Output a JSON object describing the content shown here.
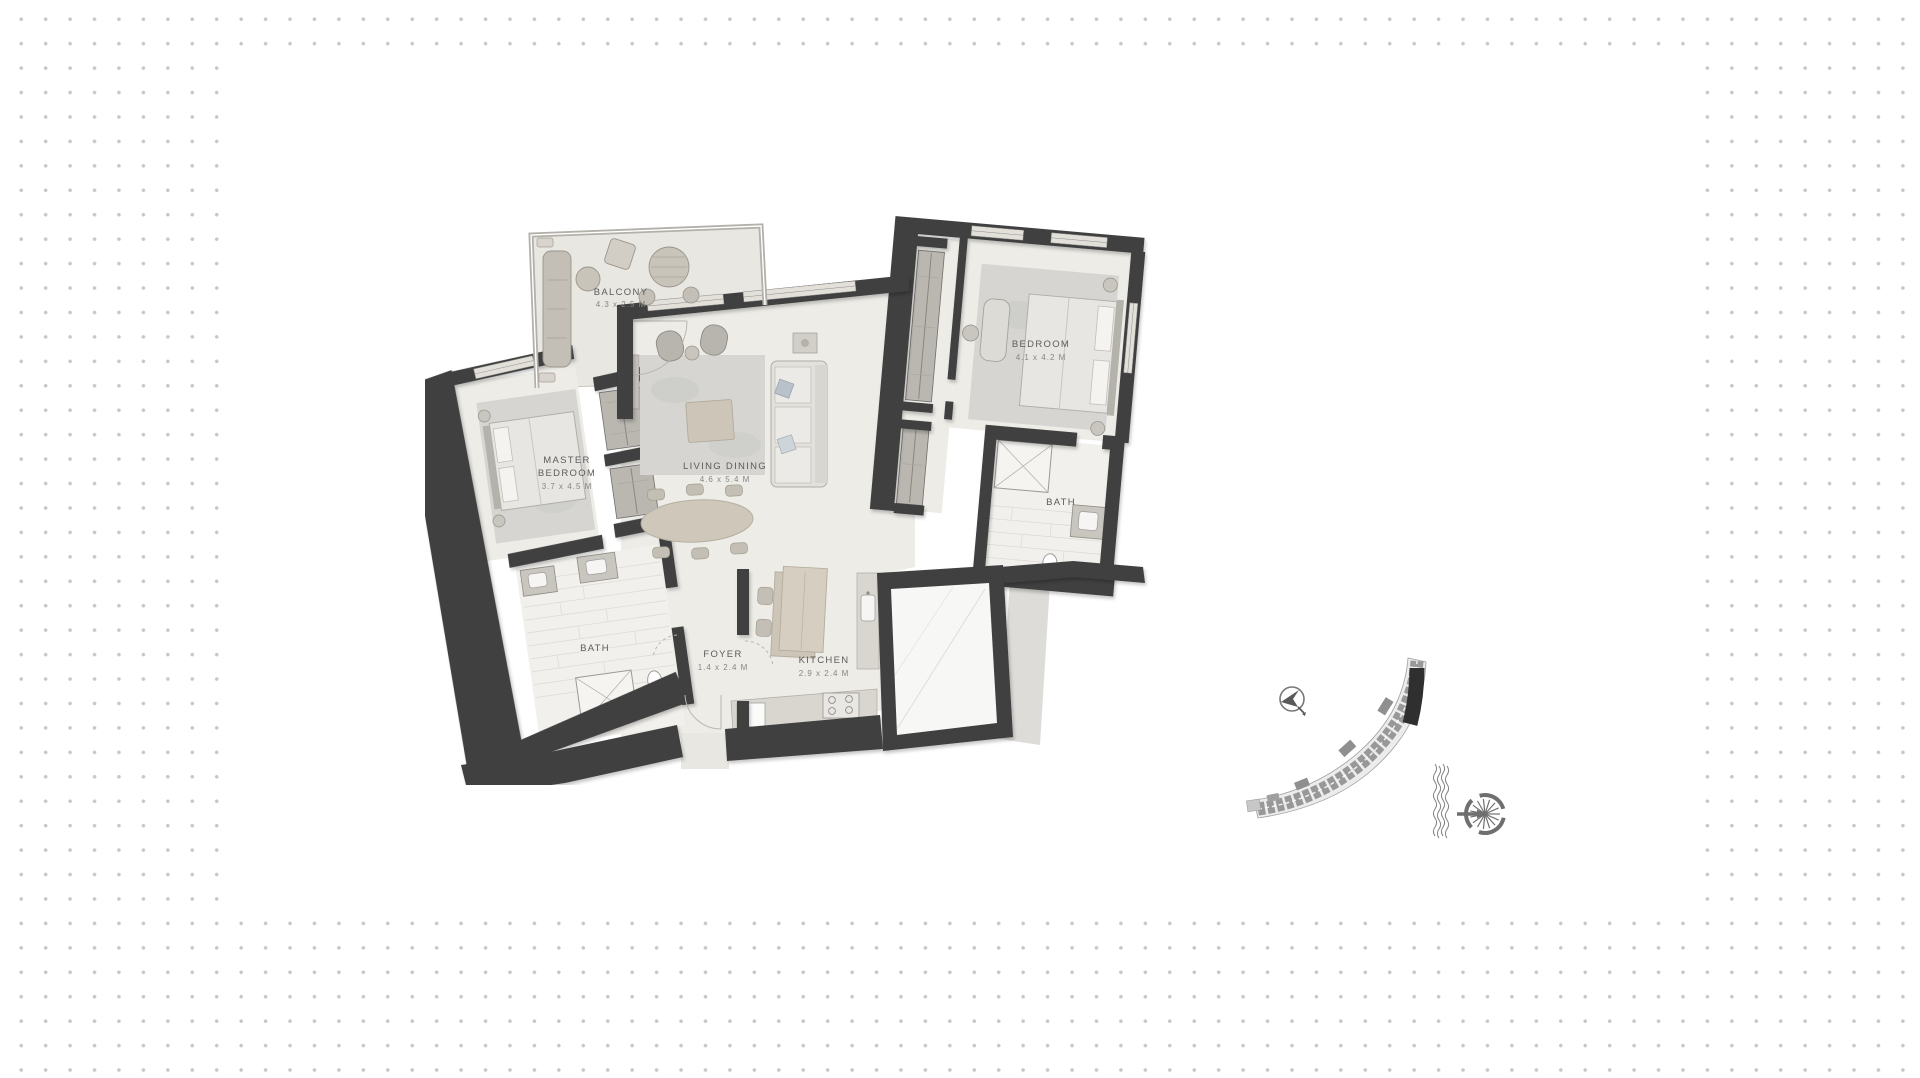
{
  "canvas": {
    "width": 1920,
    "height": 1078,
    "background": "#ffffff",
    "dot_color": "#c6c6c6",
    "panel_color": "#ffffff"
  },
  "floor_plan": {
    "rooms": {
      "balcony": {
        "name": "BALCONY",
        "dims": "4.3 x 2.5 M"
      },
      "living_dining": {
        "name": "LIVING DINING",
        "dims": "4.6 x 5.4 M"
      },
      "master_bedroom": {
        "name_line1": "MASTER",
        "name_line2": "BEDROOM",
        "dims": "3.7 x 4.5 M"
      },
      "bedroom": {
        "name": "BEDROOM",
        "dims": "4.1 x 4.2 M"
      },
      "master_bath": {
        "name": "BATH"
      },
      "bedroom_bath": {
        "name": "BATH"
      },
      "foyer": {
        "name": "FOYER",
        "dims": "1.4 x 2.4 M"
      },
      "kitchen": {
        "name": "KITCHEN",
        "dims": "2.9 x 2.4 M"
      }
    },
    "colors": {
      "wall": "#3f3f3f",
      "floor": "#edece7",
      "rug": "#d6d5d2",
      "tile_floor": "#f2f0ec",
      "wood": "#cfc8ba",
      "label": "#5c5c5c",
      "dims_label": "#868686"
    }
  },
  "site_plan": {
    "icons": [
      {
        "name": "north-arrow-icon"
      },
      {
        "name": "building-crescent-plan"
      },
      {
        "name": "shoreline-waves-icon"
      },
      {
        "name": "palm-jumeirah-icon"
      }
    ],
    "highlight_color": "#2f2f2f",
    "line_color": "#6f6f6f"
  }
}
